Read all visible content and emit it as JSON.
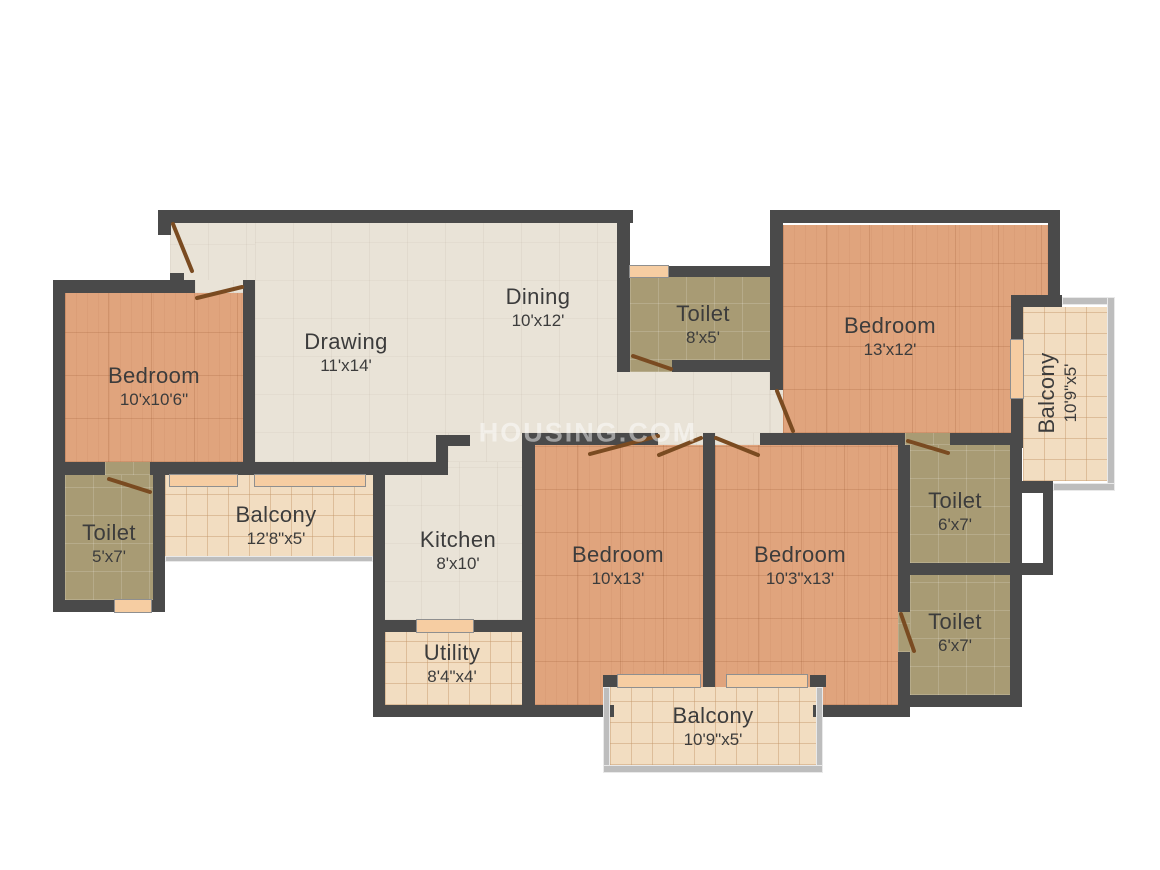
{
  "watermark": "HOUSING.COM",
  "colors": {
    "wall": "#4a4a4a",
    "bedroom_floor": "#e0a47d",
    "toilet_floor": "#a89b74",
    "balcony_floor": "#f2ddc1",
    "living_floor": "#e9e3d7",
    "door_leaf": "#7a4b21",
    "sill": "#f6cda2"
  },
  "rooms": [
    {
      "id": "bedroom-left",
      "name": "Bedroom",
      "dims": "10'x10'6\""
    },
    {
      "id": "toilet-left",
      "name": "Toilet",
      "dims": "5'x7'"
    },
    {
      "id": "balcony-left",
      "name": "Balcony",
      "dims": "12'8\"x5'"
    },
    {
      "id": "drawing",
      "name": "Drawing",
      "dims": "11'x14'"
    },
    {
      "id": "dining",
      "name": "Dining",
      "dims": "10'x12'"
    },
    {
      "id": "kitchen",
      "name": "Kitchen",
      "dims": "8'x10'"
    },
    {
      "id": "utility",
      "name": "Utility",
      "dims": "8'4\"x4'"
    },
    {
      "id": "toilet-top",
      "name": "Toilet",
      "dims": "8'x5'"
    },
    {
      "id": "bedroom-top-right",
      "name": "Bedroom",
      "dims": "13'x12'"
    },
    {
      "id": "balcony-right",
      "name": "Balcony",
      "dims": "10'9\"x5'"
    },
    {
      "id": "toilet-upper-right",
      "name": "Toilet",
      "dims": "6'x7'"
    },
    {
      "id": "toilet-lower-right",
      "name": "Toilet",
      "dims": "6'x7'"
    },
    {
      "id": "bedroom-center",
      "name": "Bedroom",
      "dims": "10'x13'"
    },
    {
      "id": "bedroom-center-right",
      "name": "Bedroom",
      "dims": "10'3\"x13'"
    },
    {
      "id": "balcony-bottom",
      "name": "Balcony",
      "dims": "10'9\"x5'"
    }
  ]
}
